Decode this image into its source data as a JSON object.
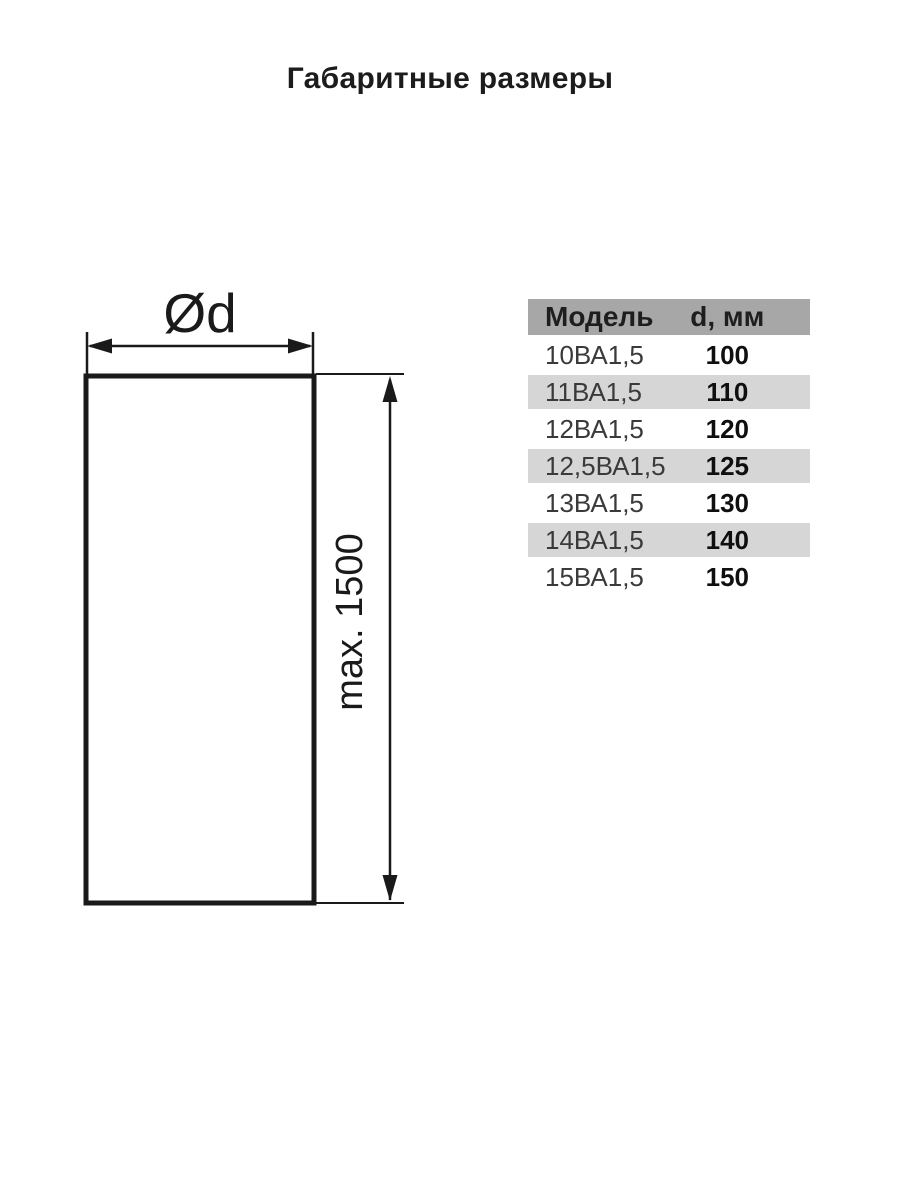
{
  "title": "Габаритные размеры",
  "diagram": {
    "diameter_label": "Ød",
    "height_label": "max. 1500",
    "stroke_color": "#1a1a1a"
  },
  "table": {
    "headers": {
      "model": "Модель",
      "diameter": "d, мм"
    },
    "rows": [
      {
        "model": "10ВА1,5",
        "value": "100"
      },
      {
        "model": "11ВА1,5",
        "value": "110"
      },
      {
        "model": "12ВА1,5",
        "value": "120"
      },
      {
        "model": "12,5ВА1,5",
        "value": "125"
      },
      {
        "model": "13ВА1,5",
        "value": "130"
      },
      {
        "model": "14ВА1,5",
        "value": "140"
      },
      {
        "model": "15ВА1,5",
        "value": "150"
      }
    ],
    "colors": {
      "header_bg": "#a7a7a7",
      "alt_row_bg": "#d6d6d6"
    }
  }
}
